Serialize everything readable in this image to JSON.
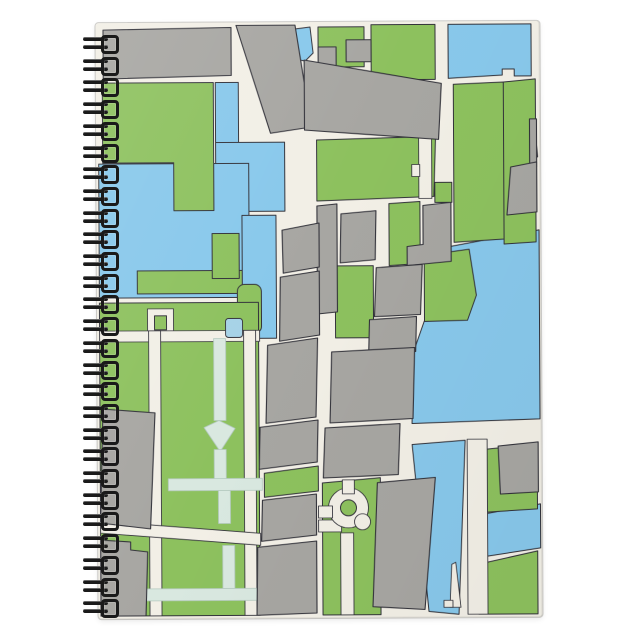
{
  "scene": {
    "subject": "spiral-bound notebook, portrait orientation, photographed on plain white background",
    "background_color": "#ffffff",
    "cover_art": "abstract city street map with parks, waterways and building blocks, no text or labels"
  },
  "notebook": {
    "cover_base_color": "#f2efe6",
    "spiral": {
      "side": "left",
      "ring_count": 27,
      "ring_style": "double-wire loops",
      "ring_color": "#1a1a1a",
      "first_ring_y": 36,
      "ring_pitch": 21.7
    }
  },
  "map_palette": {
    "street_cream": "#f2efe6",
    "park_green": "#8cc25b",
    "water_blue": "#86c8ec",
    "building_gray": "#a7a6a2",
    "outline_ink": "#32323a",
    "path_pale": "#d9e8e0",
    "pond_blue": "#a5d2e8"
  },
  "map_features": [
    "rectangular water basin at top right",
    "large lake on middle right edge",
    "vertical canal network through center-left and bottom center",
    "big park with pale pathway grid and small pond at bottom left",
    "roundabout loop road at bottom center",
    "thin pier in bottom canal",
    "column of gray city blocks through the middle",
    "diagonal avenue crossing the lower-left park"
  ]
}
